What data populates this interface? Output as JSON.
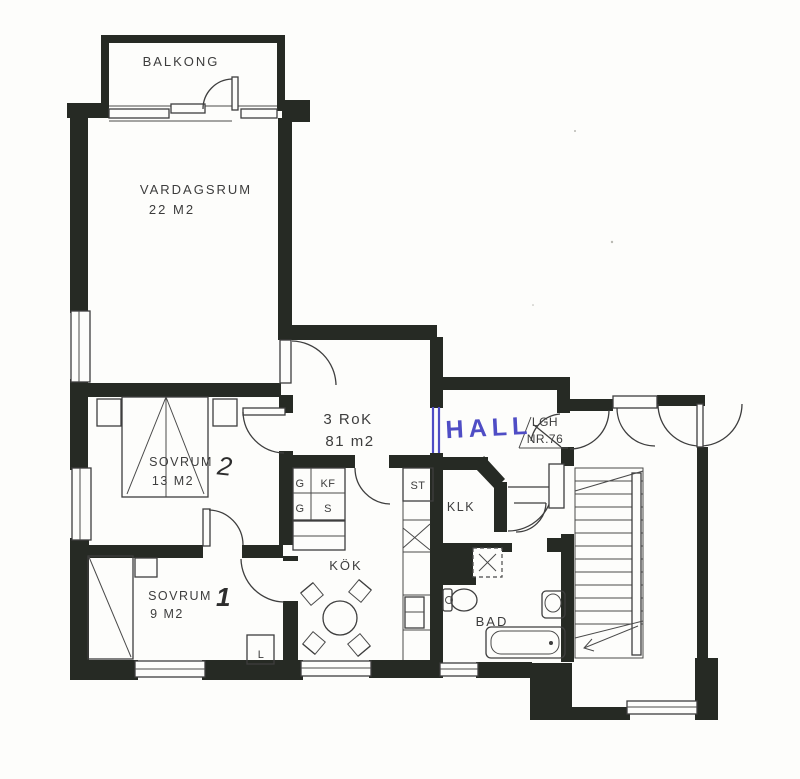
{
  "plan_title": "3 RoK",
  "plan_area": "81 m2",
  "colors": {
    "wall": "#262a24",
    "line": "#3e3e3e",
    "ink_blue": "#4f4dc5",
    "paper": "#fdfdfb",
    "text": "#3d3d3d"
  },
  "rooms": {
    "balcony": {
      "label": "BALKONG"
    },
    "living": {
      "label": "VARDAGSRUM",
      "area": "22 M2"
    },
    "hall": {
      "label": "HALL"
    },
    "apartment_tag": {
      "line1": "LGH",
      "line2": "NR.76"
    },
    "bedroom2": {
      "label": "SOVRUM",
      "number": "2",
      "area": "13 M2"
    },
    "bedroom1": {
      "label": "SOVRUM",
      "number": "1",
      "area": "9 M2"
    },
    "kitchen": {
      "label": "KÖK"
    },
    "closet": {
      "label": "KLK"
    },
    "bath": {
      "label": "BAD"
    }
  },
  "fixtures": {
    "wardrobe_top": "G",
    "fridge": "KF",
    "wardrobe_bottom": "G",
    "cleaning_cabinet": "S",
    "pantry": "ST",
    "linen_cabinet": "L"
  }
}
